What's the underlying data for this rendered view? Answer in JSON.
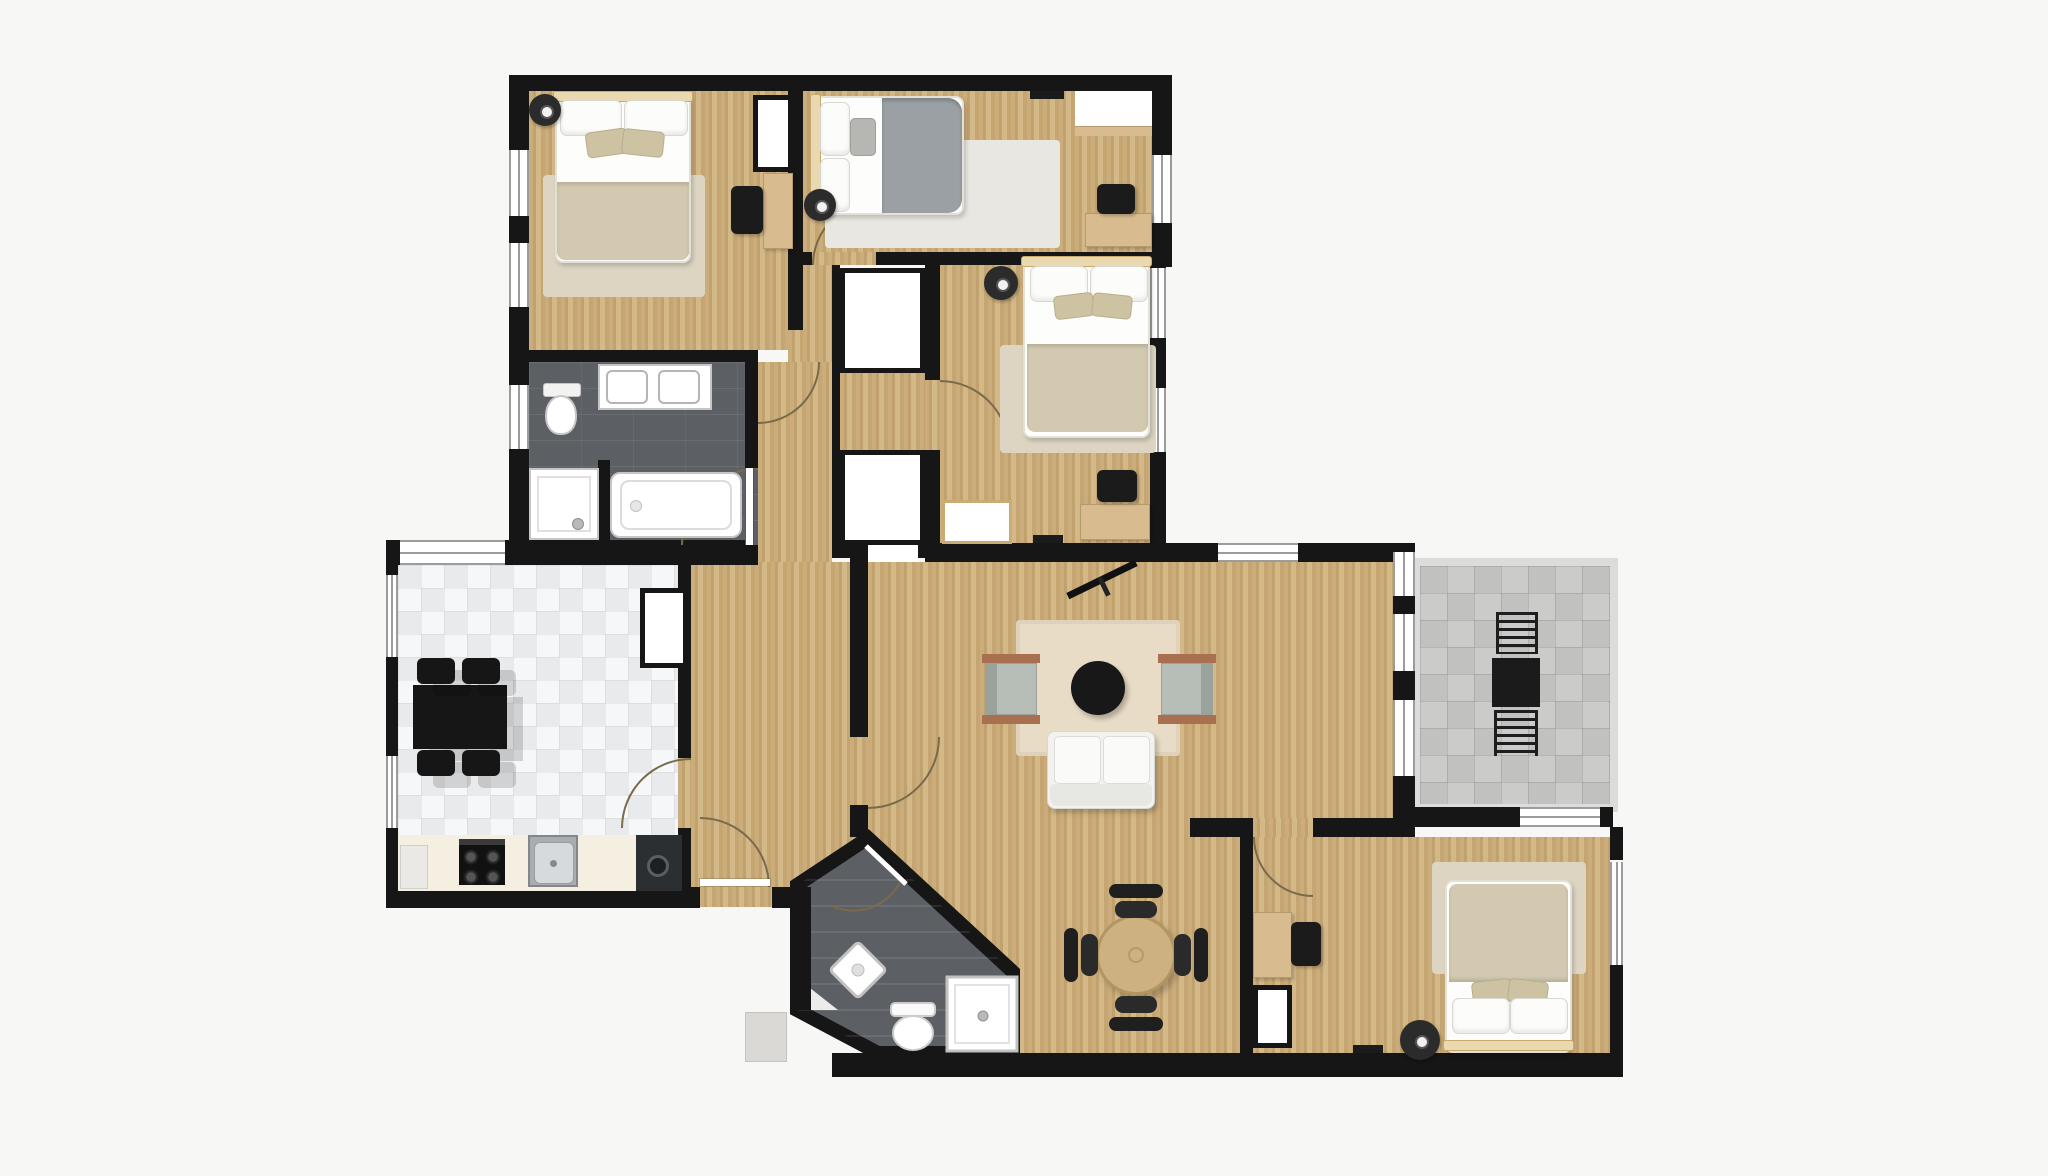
{
  "palette": {
    "bg": "#f7f7f5",
    "wall": "#161616",
    "woodA": "#cbad7c",
    "woodB": "#c1a26e",
    "woodC": "#d3b888",
    "tileKitchen": "#edeff0",
    "tileBath": "#5c6064",
    "patioTile": "#c8c8c6",
    "counter": "#f5efe2",
    "rugBeige": "#e8dcc6",
    "rugTan": "#ddd5c2",
    "rugLight": "#e9e7e1",
    "blanketTan": "#d2c9b0",
    "blanketGray": "#9aa0a3",
    "headboard": "#ead9ae",
    "pillowAccent": "#cdc3a2",
    "sofaWhite": "#f2f2f0",
    "armchairGray": "#b7beb8",
    "armchairWood": "#a8704f",
    "deskWood": "#d8bc90",
    "furnitureBlack": "#1b1b1b",
    "diningTableWood": "#cdb181",
    "doorArc": "#7a6a4a",
    "windowFrame": "#9c9c9c"
  },
  "rooms": {
    "bedroom1": {
      "label": "bedroom-1",
      "floor": "wood"
    },
    "bedroom2": {
      "label": "bedroom-2",
      "floor": "wood"
    },
    "bedroom3": {
      "label": "bedroom-3",
      "floor": "wood"
    },
    "bedroom4": {
      "label": "bedroom-4",
      "floor": "wood"
    },
    "bathroom_main": {
      "label": "main-bathroom",
      "floor": "dark-tile"
    },
    "bathroom_second": {
      "label": "shower-room",
      "floor": "dark-tile"
    },
    "kitchen": {
      "label": "kitchen-dining",
      "floor": "white-tile"
    },
    "hallway": {
      "label": "hallway",
      "floor": "wood"
    },
    "living_room": {
      "label": "living-room",
      "floor": "wood"
    },
    "dining_area": {
      "label": "breakfast-area",
      "floor": "wood"
    },
    "patio": {
      "label": "patio",
      "floor": "stone-tile"
    },
    "entry": {
      "label": "entry",
      "floor": "wood"
    }
  },
  "fixtures": [
    "double-bed-x4",
    "area-rug-x5",
    "ceiling-light-x4",
    "desk-with-chair-x5",
    "wardrobe-closet-x6",
    "double-sink-vanity",
    "toilet-x2",
    "bathtub",
    "shower-x2",
    "corner-sink",
    "kitchen-table-4-chairs",
    "stove",
    "kitchen-sink",
    "dishwasher",
    "round-dining-table-4-chairs",
    "loveseat-sofa",
    "armchair-x2",
    "round-coffee-table",
    "wall-tv",
    "bistro-table-2-chairs"
  ]
}
